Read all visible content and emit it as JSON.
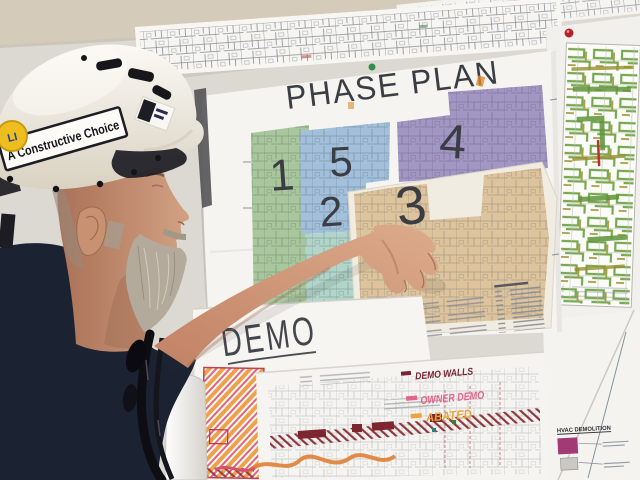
{
  "hat": {
    "sticker": "A Constructive Choice",
    "logo": "LI",
    "shell_color": "#f2eee4"
  },
  "worker": {
    "shirt_color": "#1b2231"
  },
  "wall_writing": {
    "top": "NE",
    "bottom": "S"
  },
  "phase_plan": {
    "title": "PHASE PLAN",
    "zones": [
      {
        "number": "1",
        "color": "#a9c79c"
      },
      {
        "number": "5",
        "color": "#a2c0db"
      },
      {
        "number": "2",
        "color": "#b2d5ca"
      },
      {
        "number": "4",
        "color": "#a296c4"
      },
      {
        "number": "3",
        "color": "#ddc49d"
      }
    ]
  },
  "demo_sheet": {
    "title": "DEMO"
  },
  "marker_legend": {
    "items": [
      {
        "label": "DEMO WALLS",
        "color": "#7c2330"
      },
      {
        "label": "OWNER DEMO",
        "color": "#e2638c"
      },
      {
        "label": "ABATED",
        "color": "#e9a53c"
      }
    ]
  },
  "hvac_legend": {
    "title": "HVAC DEMOLITION",
    "swatch_color": "#a23a76"
  },
  "pins": {
    "phase_pin_color": "#2f8f4f",
    "demo_pin_color": "#2f8f4f",
    "right_sheet_pin_color": "#b5232a"
  }
}
